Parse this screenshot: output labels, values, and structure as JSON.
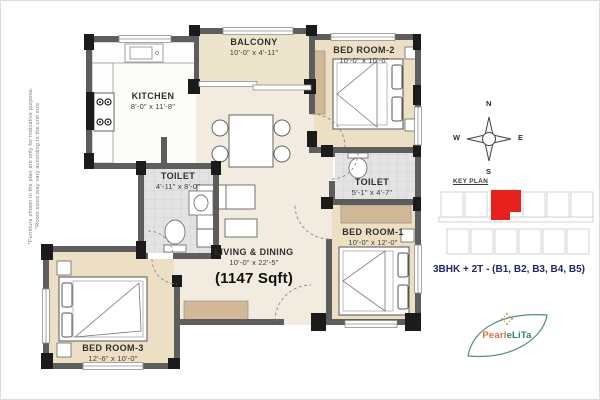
{
  "plan": {
    "rooms": {
      "balcony": {
        "name": "BALCONY",
        "dim": "10'-0\" x 4'-11\""
      },
      "kitchen": {
        "name": "KITCHEN",
        "dim": "8'-0\" x 11'-8\""
      },
      "bedroom2": {
        "name": "BED ROOM-2",
        "dim": "10'-0\" x 10'-0\""
      },
      "toilet1": {
        "name": "TOILET",
        "dim": "4'-11\" x 8'-0\""
      },
      "toilet2": {
        "name": "TOILET",
        "dim": "5'-1\" x 4'-7\""
      },
      "living": {
        "name": "LIVING & DINING",
        "dim": "10'-0\" x 22'-5\"",
        "area": "(1147 Sqft)"
      },
      "bedroom1": {
        "name": "BED ROOM-1",
        "dim": "10'-0\" x 12'-0\""
      },
      "bedroom3": {
        "name": "BED ROOM-3",
        "dim": "12'-6\" x 10'-0\""
      }
    },
    "disclaimer": {
      "furniture_note": "*Furniture shown in the plan are only for indicative purpose.",
      "room_note": "*Room sizes may vary according to the unit size"
    }
  },
  "compass": {
    "north": "N",
    "south": "S",
    "east": "E",
    "west": "W"
  },
  "key_plan": {
    "label": "KEY PLAN"
  },
  "unit_info": {
    "text": "3BHK + 2T - (B1, B2, B3, B4, B5)"
  },
  "logo": {
    "name_part1": "Pearl",
    "name_part2": "eLiTa"
  },
  "colors": {
    "bedroom_beige": "#ecdfc4",
    "balcony_beige": "#ece4cb",
    "living_cream": "#f1ecdf",
    "toilet_gray": "#e3e3e3",
    "wardrobe_tan": "#d3b897",
    "wall_gray": "#5d5d5d",
    "column_black": "#1b1b1b",
    "keyplan_red": "#e8211d",
    "unit_text_navy": "#24246a",
    "logo_green": "#2f8465",
    "logo_orange": "#e0703c"
  }
}
